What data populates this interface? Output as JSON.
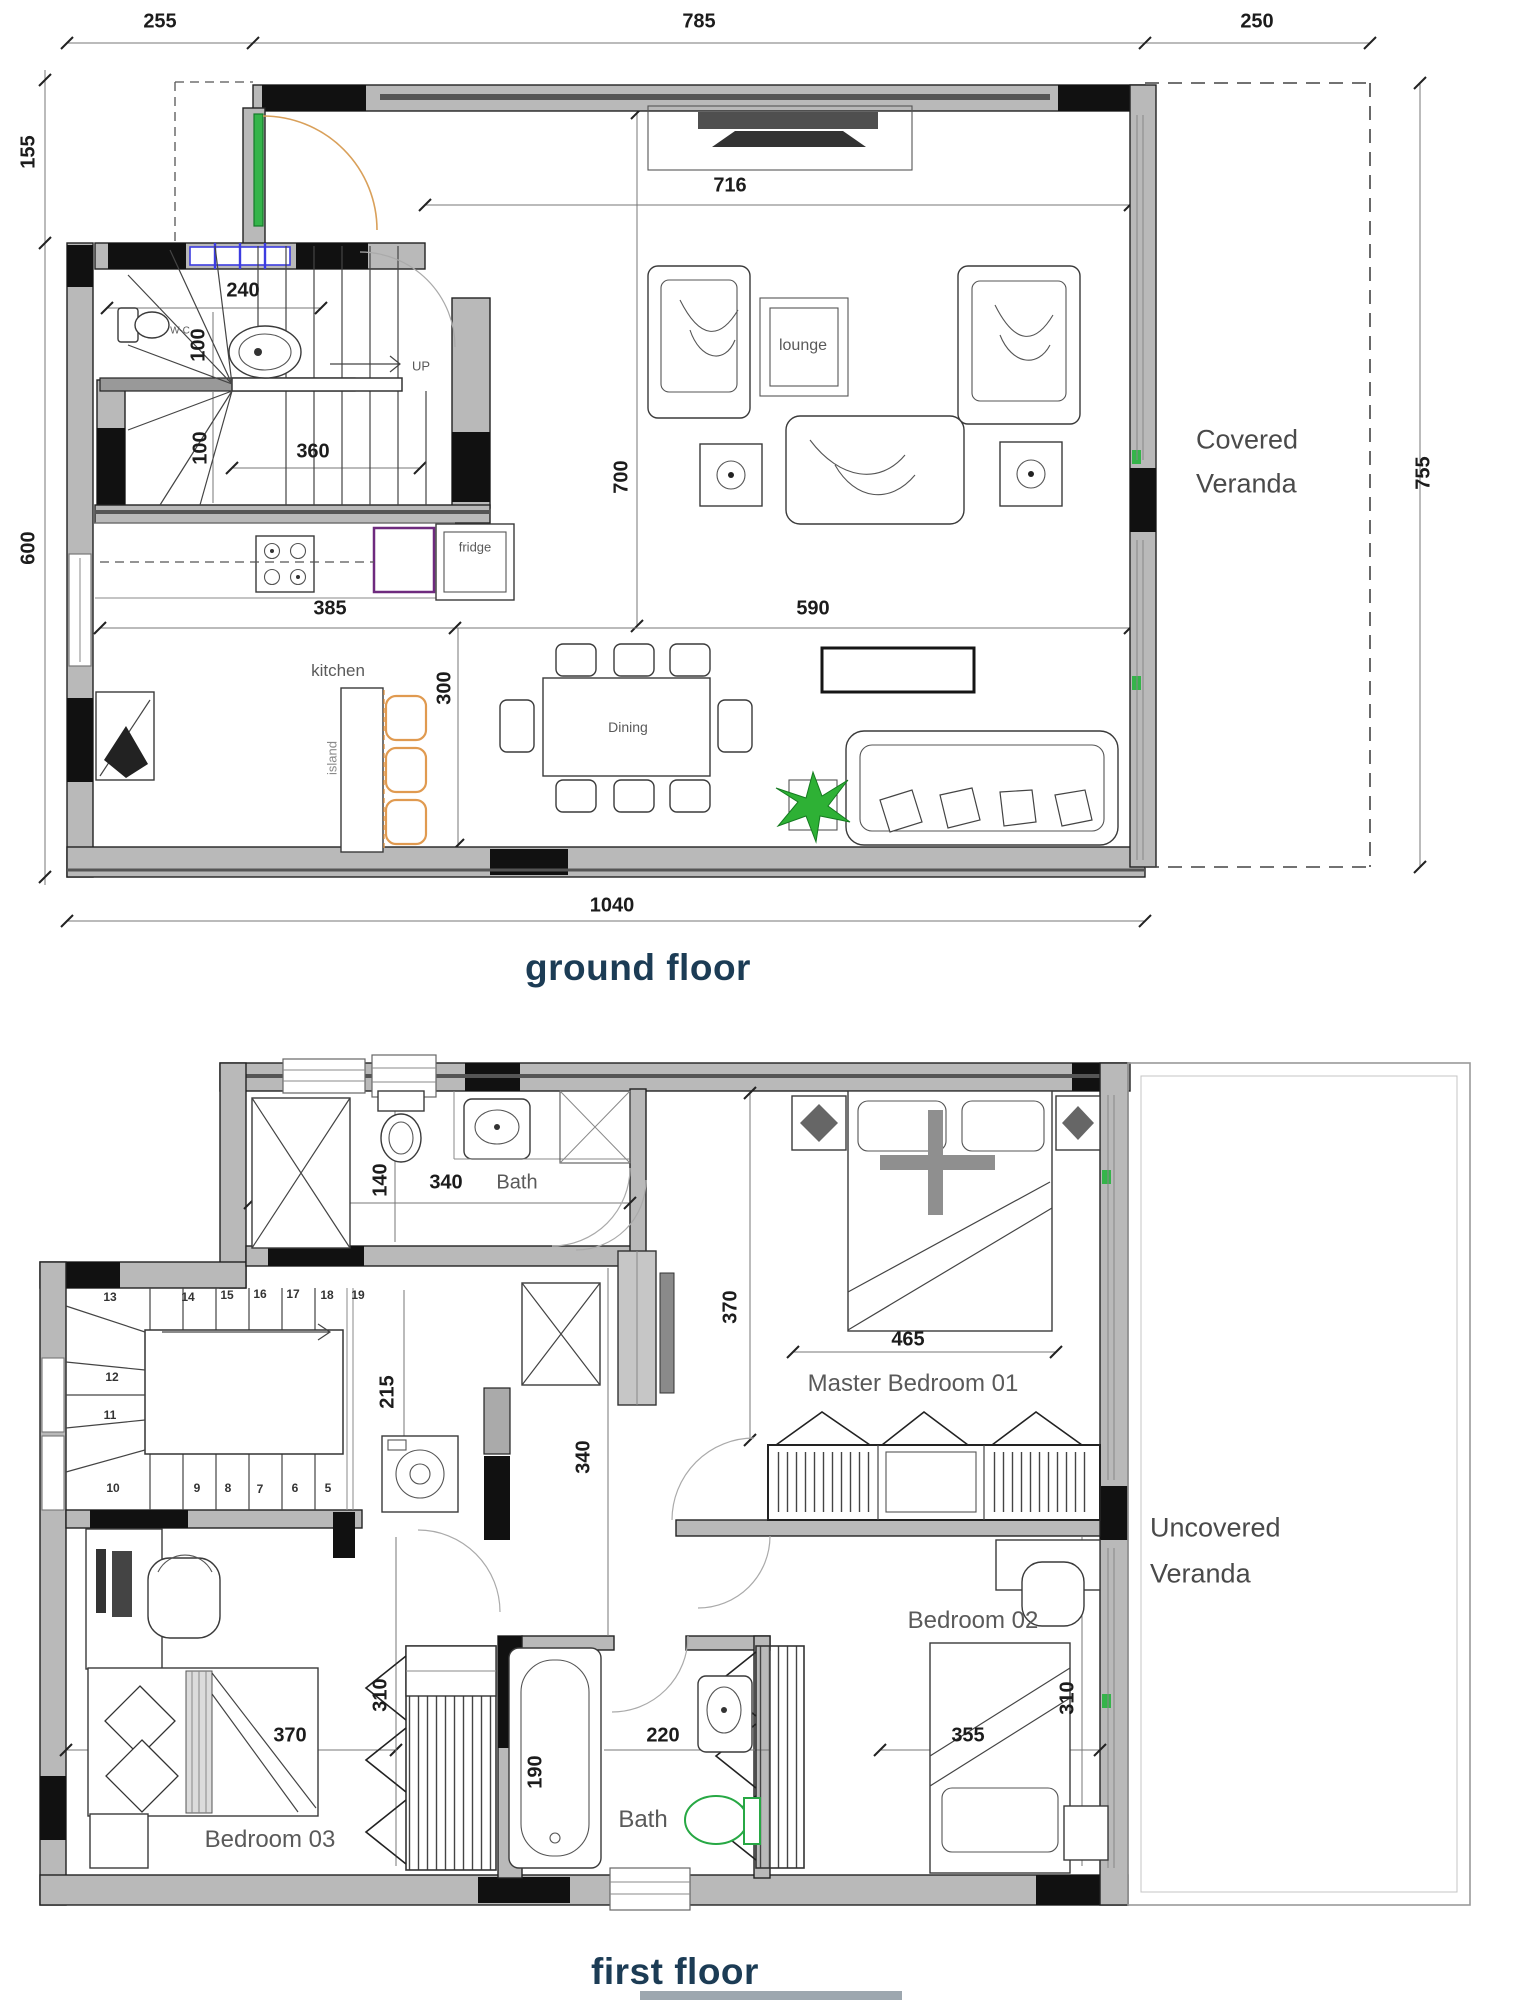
{
  "colors": {
    "wall_gray": "#b9b9b9",
    "wall_black": "#111111",
    "title_navy": "#1c3c55",
    "accent_green": "#35b44a",
    "accent_orange": "#e09a50",
    "accent_blue": "#3c3ce0",
    "accent_purple": "#6e2a7e",
    "label_gray": "#5a5a5a"
  },
  "gf": {
    "title": "ground floor",
    "dims": {
      "top_left": "255",
      "top_mid": "785",
      "top_right": "250",
      "left_upper": "155",
      "left_lower": "600",
      "right": "755",
      "bottom": "1040",
      "lounge_w": "716",
      "lounge_h": "700",
      "hall": "240",
      "wc_a": "100",
      "wc_b": "100",
      "stair": "360",
      "kitchen_w": "385",
      "kitchen_h": "300",
      "dining_w": "590"
    },
    "labels": {
      "wc": "W-C",
      "up": "UP",
      "lounge": "lounge",
      "fridge": "fridge",
      "kitchen": "kitchen",
      "island": "island",
      "dining": "Dining",
      "veranda_line1": "Covered",
      "veranda_line2": "Veranda"
    }
  },
  "ff": {
    "title": "first floor",
    "dims": {
      "wc": "140",
      "bath_w": "340",
      "closet": "370",
      "bed1": "465",
      "stair": "215",
      "hall": "340",
      "b3_wardrobe": "310",
      "b3_bed": "370",
      "tub": "190",
      "bath2_w": "220",
      "b2_bed": "355",
      "b2": "310"
    },
    "labels": {
      "bath_top": "Bath",
      "master": "Master Bedroom 01",
      "bedroom2": "Bedroom 02",
      "bedroom3": "Bedroom 03",
      "bath_bottom": "Bath",
      "veranda_line1": "Uncovered",
      "veranda_line2": "Veranda"
    },
    "stairs_top": [
      "13",
      "14",
      "15",
      "16",
      "17",
      "18",
      "19"
    ],
    "stairs_left": [
      "12",
      "11"
    ],
    "stairs_bottom": [
      "10",
      "9",
      "8",
      "7",
      "6",
      "5"
    ]
  }
}
